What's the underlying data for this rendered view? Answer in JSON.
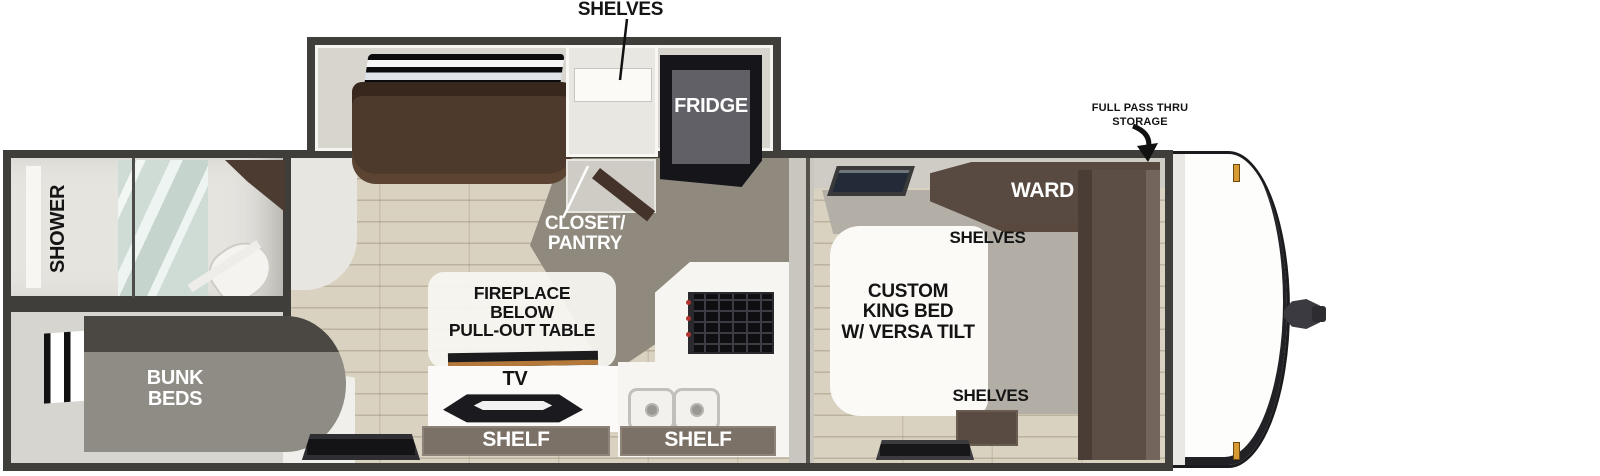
{
  "floorplan": {
    "slideout": {
      "shelves_label": "SHELVES",
      "sofa_label": "68”\nJACKKNIFE\nSOFA",
      "fridge_label": "FRIDGE"
    },
    "rear": {
      "shower_label": "SHOWER",
      "bunk_label": "BUNK\nBEDS"
    },
    "main": {
      "closet_label": "CLOSET/\nPANTRY",
      "fireplace_label": "FIREPLACE\nBELOW\nPULL-OUT TABLE",
      "tv_label": "TV",
      "shelf_left_label": "SHELF",
      "shelf_right_label": "SHELF"
    },
    "bedroom": {
      "ward_label": "WARD",
      "shelves_top_label": "SHELVES",
      "bed_label": "CUSTOM\nKING BED\nW/ VERSA TILT",
      "shelves_bottom_label": "SHELVES"
    },
    "front": {
      "storage_label": "FULL PASS THRU\nSTORAGE"
    },
    "colors": {
      "wall_border": "#403e3b",
      "interior_wall": "#d8d5cf",
      "floor_plank": "#d9d2c1",
      "aisle_gray": "#8f8a7d",
      "sofa_brown": "#4e3a2c",
      "cabinet_brown": "#584a41",
      "shelf_bar": "#7c7166",
      "counter_white": "#f6f5f2",
      "appliance_black": "#17171a",
      "shower_glass": "#cfdcd6",
      "marker_light_orange": "#d89a33"
    }
  }
}
